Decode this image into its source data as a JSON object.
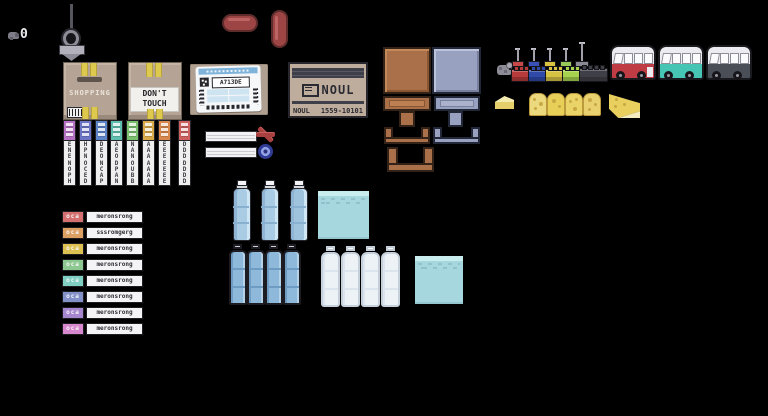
{
  "hud": {
    "counter": "0"
  },
  "boxes": {
    "shopping": {
      "label": "SHOPPING"
    },
    "dont_touch": {
      "line1": "DON'T",
      "line2": "TOUCH"
    },
    "shipping": {
      "code": "A713DE"
    },
    "noul": {
      "logo": "NOUL",
      "bottom_left": "NOUL",
      "serial": "1559-10101"
    }
  },
  "strips": [
    {
      "color": "#b571c4",
      "letters": "E\nN\nE\nN\nO\nP\nH"
    },
    {
      "color": "#6b74c6",
      "letters": "H\nP\nN\nO\nC\nE\nD"
    },
    {
      "color": "#5d83c9",
      "letters": "D\nE\nO\nN\nC\nA\nP"
    },
    {
      "color": "#5fbfae",
      "letters": "A\nE\nO\nD\nP\nA\nN"
    },
    {
      "color": "#7abf6d",
      "letters": "N\nA\nN\nO\nU\nB\nB"
    },
    {
      "color": "#d9aa49",
      "letters": "A\nA\nA\nA\nA\nA\nA"
    },
    {
      "color": "#d9884d",
      "letters": "E\nE\nE\nE\nE\nE\nE"
    },
    {
      "color": "#cd5f5f",
      "letters": "D\nD\nD\nD\nD\nD\nD"
    }
  ],
  "rows": [
    {
      "color": "#d66f6f",
      "tag": "oca",
      "label": "meronsrong"
    },
    {
      "color": "#de9f63",
      "tag": "oca",
      "label": "sssromgerg"
    },
    {
      "color": "#dcc052",
      "tag": "oca",
      "label": "meronsrong"
    },
    {
      "color": "#8cc88f",
      "tag": "oca",
      "label": "meronsrong"
    },
    {
      "color": "#7fd0c3",
      "tag": "oca",
      "label": "meronsrong"
    },
    {
      "color": "#8391c9",
      "tag": "oca",
      "label": "meronsrong"
    },
    {
      "color": "#a687cf",
      "tag": "oca",
      "label": "meronsrong"
    },
    {
      "color": "#d687cd",
      "tag": "oca",
      "label": "meronsrong"
    }
  ],
  "colors": {
    "background": "#000000",
    "cardboard": "#b5a496",
    "tape_yellow": "#dcc94e",
    "shipping_label_blue": "#7fb3da",
    "sausage_red": "#9d4545",
    "furniture_brown": "#a9704a",
    "furniture_steel": "#99a1c0",
    "bus_red": "#c03c44",
    "bus_teal": "#46c4b4",
    "bus_grey": "#4a4e56",
    "cheese_yellow": "#e8cf5e",
    "water_bottle_blue": "#a9cbe4",
    "ice_cyan": "#a6d7df",
    "stamp_x_red": "#a84040",
    "stamp_o_blue": "#303c96",
    "brick_red": "#b83a3a",
    "brick_blue": "#2f4aa8",
    "brick_yellow": "#d6c344",
    "brick_green": "#a6d44e",
    "brick_dark": "#3f3f47"
  }
}
